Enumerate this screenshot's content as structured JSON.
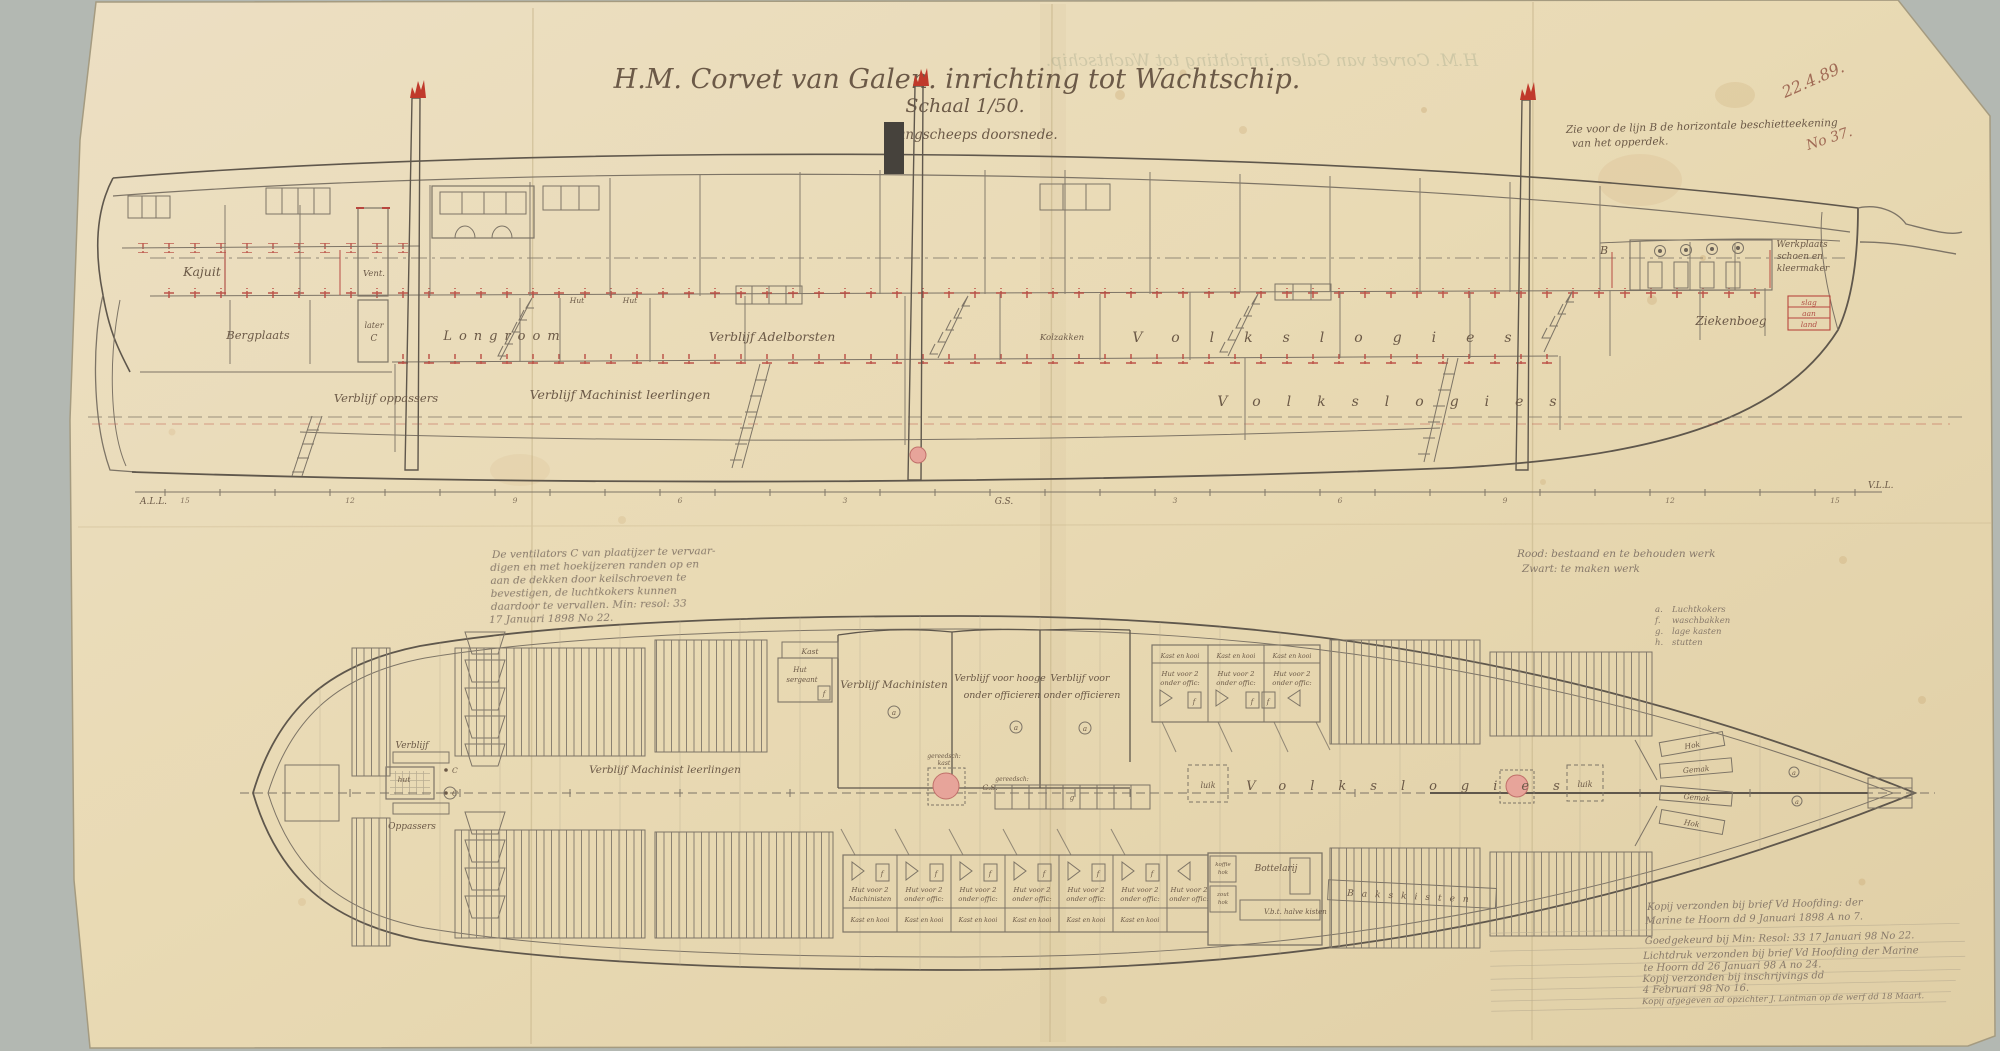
{
  "document": {
    "title": "H.M. Corvet van Galen. inrichting tot Wachtschip.",
    "scale_label": "Schaal 1/50.",
    "view_profile": "Langscheeps doorsnede.",
    "pencil_date": "22.4.89.",
    "pencil_number": "No 37.",
    "note_line_b_1": "Zie voor de lijn B de horizontale beschietteekening",
    "note_line_b_2": "van het opperdek.",
    "line_b_marker": "B"
  },
  "profile": {
    "rooms": {
      "kajuit": "Kajuit",
      "vent": "Vent.",
      "bergplaats": "Bergplaats",
      "later": "later",
      "later_c": "C",
      "longroom": "Longroom",
      "hut_a": "Hut",
      "hut_b": "Hut",
      "adelborsten": "Verblijf Adelborsten",
      "kolzakken": "Kolzakken",
      "oppassers": "Verblijf oppassers",
      "machinist_leerlingen": "Verblijf Machinist leerlingen",
      "volkslogies": "Volkslogies",
      "ziekenboeg": "Ziekenboeg",
      "werkplaats_1": "Werkplaats",
      "werkplaats_2": "schoen en",
      "werkplaats_3": "kleermaker",
      "slag": "slag",
      "aan": "aan",
      "land": "land"
    },
    "scale_bar": {
      "left": "A.L.L.",
      "center": "G.S.",
      "right": "V.L.L.",
      "numbers": [
        "15",
        "12",
        "9",
        "6",
        "3",
        "3",
        "6",
        "9",
        "12",
        "15"
      ]
    }
  },
  "plan": {
    "rooms": {
      "verblijf": "Verblijf",
      "hut": "hut",
      "c": "C",
      "oppassers": "Oppassers",
      "machinist_leerlingen": "Verblijf Machinist leerlingen",
      "kast": "Kast",
      "hut_sergeant_1": "Hut",
      "hut_sergeant_2": "sergeant",
      "machinisten": "Verblijf Machinisten",
      "hooge_1": "Verblijf voor hooge",
      "hooge_2": "onder officieren",
      "onder_1": "Verblijf voor",
      "onder_2": "onder officieren",
      "kast_en_kooi": "Kast en kooi",
      "hut2_1": "Hut voor 2",
      "hut2_off": "onder offic:",
      "hut2_mach": "Machinisten",
      "bottelarij": "Bottelarij",
      "koffie": "koffie",
      "zout": "zout",
      "hok_txt": "hok",
      "halve_kisten": "V.b.t. halve kisten",
      "bakskisten": "Bakskisten",
      "volkslogies": "Volkslogies",
      "luik": "luik",
      "gemak": "Gemak",
      "hok": "Hok",
      "gs": "G.S.",
      "gereedschap_1": "gereedsch:",
      "gereedschap_2": "kast"
    },
    "markers": {
      "a": "a",
      "f": "f",
      "g": "g"
    }
  },
  "notes": {
    "ventilator_note": [
      "De ventilators C van plaatijzer te vervaar-",
      "digen en met hoekijzeren randen op en",
      "aan de dekken door keilschroeven te",
      "bevestigen, de luchtkokers kunnen",
      "daardoor te vervallen. Min: resol: 33",
      "17 Januari 1898 No 22."
    ],
    "color_key_1": "Rood: bestaand en te behouden werk",
    "color_key_2": "Zwart: te maken werk",
    "legend": [
      {
        "key": "a.",
        "label": "Luchtkokers"
      },
      {
        "key": "f.",
        "label": "waschbakken"
      },
      {
        "key": "g.",
        "label": "lage kasten"
      },
      {
        "key": "h.",
        "label": "stutten"
      }
    ],
    "registry": [
      "Kopij verzonden bij brief Vd Hoofding: der",
      "Marine te Hoorn dd 9 Januari 1898 A no 7.",
      "Goedgekeurd bij Min: Resol: 33 17 Januari 98 No 22.",
      "Lichtdruk verzonden bij brief Vd Hoofding der Marine",
      "te Hoorn dd 26 Januari 98 A no 24.",
      "Kopij verzonden bij inschrijvings dd",
      "4 Februari 98 No 16.",
      "Kopij afgegeven ad opzichter J. Lantman op de werf dd 18 Maart."
    ]
  },
  "colors": {
    "paper": "#e9dcba",
    "ink": "#6b5947",
    "line": "#7d7466",
    "red": "#b8463e",
    "pink": "#e7a49a",
    "pencil": "#87796a",
    "background": "#b3b8b2"
  }
}
